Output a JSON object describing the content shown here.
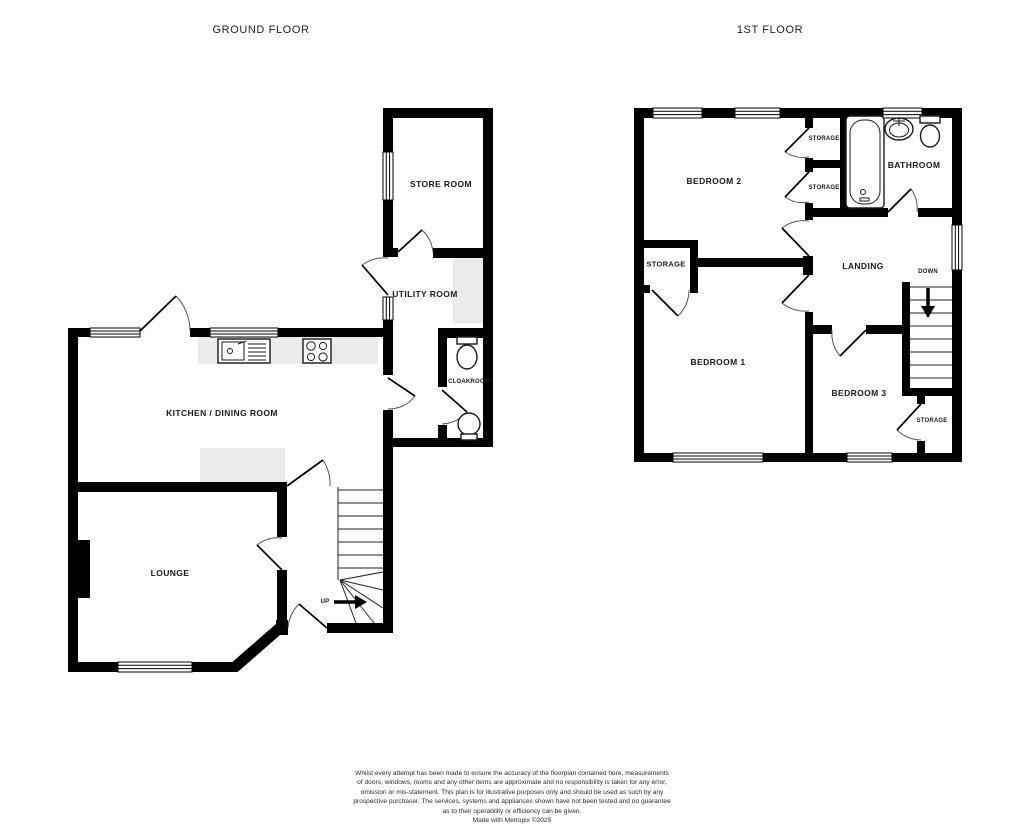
{
  "titles": {
    "ground": "GROUND FLOOR",
    "first": "1ST FLOOR"
  },
  "ground_floor": {
    "store_room": "STORE ROOM",
    "utility_room": "UTILITY ROOM",
    "kitchen_dining_room": "KITCHEN / DINING ROOM",
    "cloakroom": "CLOAKROOM",
    "lounge": "LOUNGE",
    "up": "UP"
  },
  "first_floor": {
    "bedroom_2": "BEDROOM 2",
    "storage_1": "STORAGE",
    "storage_2": "STORAGE",
    "bathroom": "BATHROOM",
    "storage_landing": "STORAGE",
    "landing": "LANDING",
    "down": "DOWN",
    "bedroom_1": "BEDROOM 1",
    "bedroom_3": "BEDROOM 3",
    "storage_bedroom_3": "STORAGE"
  },
  "icons": {
    "fixtures": [
      "bath-icon",
      "basin-icon",
      "toilet-icon",
      "kitchen-sink-icon",
      "hob-icon",
      "stairs-up-icon",
      "stairs-down-icon",
      "window-icon",
      "door-swing-icon"
    ]
  },
  "footer": {
    "lines": [
      "Whilst every attempt has been made to ensure the accuracy of the floorplan contained here, measurements",
      "of doors, windows, rooms and any other items are approximate and no responsibility is taken for any error,",
      "omission or mis-statement. This plan is for illustrative purposes only and should be used as such by any",
      "prospective purchaser. The services, systems and appliances shown have not been tested and no guarantee",
      "as to their operability or efficiency can be given.",
      "Made with Metropix ©2025"
    ]
  },
  "colors": {
    "wall": "#000000",
    "counter": "#ebebeb",
    "text": "#1a1a1a"
  }
}
